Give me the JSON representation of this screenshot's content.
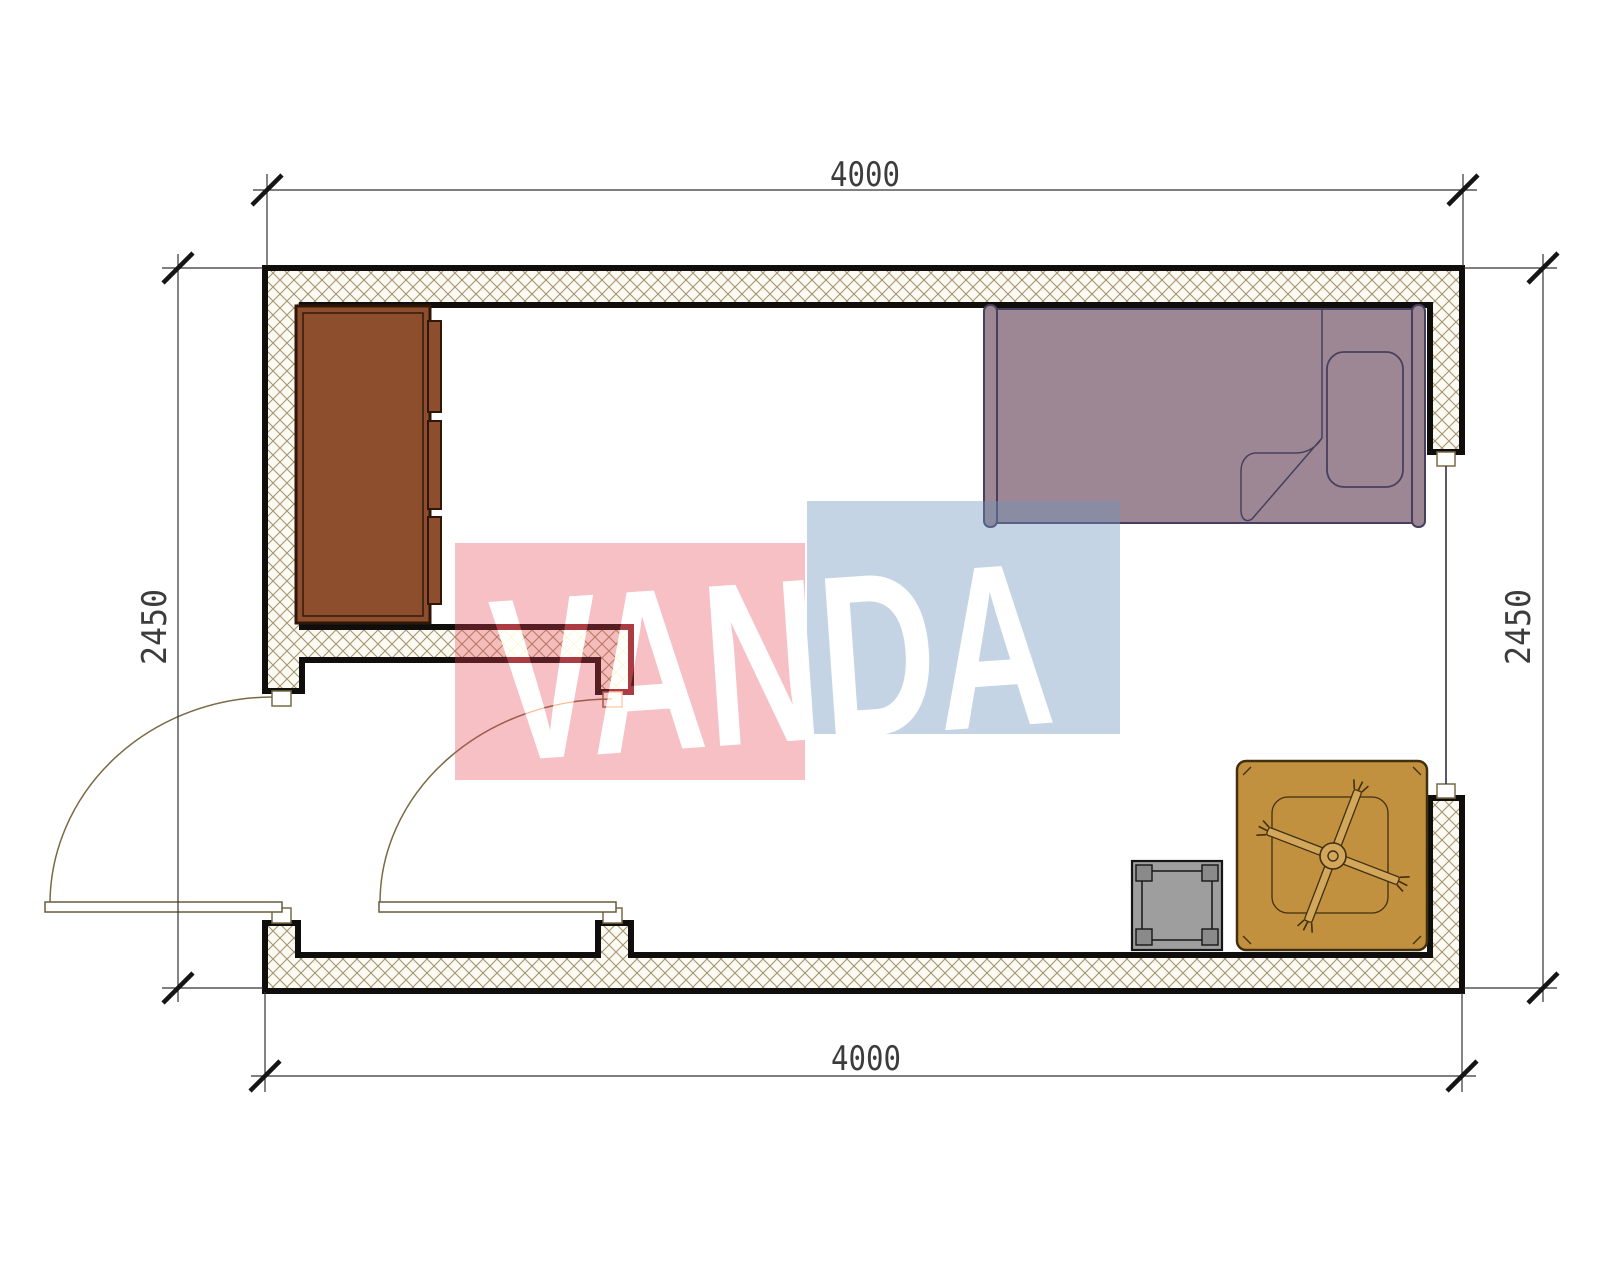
{
  "page": {
    "background": "#ffffff"
  },
  "dimensions": {
    "top": "4000",
    "bottom": "4000",
    "left": "2450",
    "right": "2450"
  },
  "watermark": {
    "text": "VANDA",
    "red": "#e8414e",
    "blue": "#6e93bb"
  },
  "colors": {
    "wall_line": "#0f0e0c",
    "hatch_line": "#a3956f",
    "hatch_bg": "#fcfaf2",
    "cabinet": "#8d4e2e",
    "cabinet_line": "#2f1608",
    "bed": "#9d8794",
    "bed_line": "#46405e",
    "table": "#c2913f",
    "table_line": "#40300e",
    "fan_blade": "#d2a75b",
    "stool": "#9e9e9e",
    "stool_leg": "#8a8a8a",
    "stool_line": "#161616",
    "door_line": "#7a6a45",
    "window_line": "#2f2f44",
    "dimension_line": "#333333",
    "dimension_text": "#3c3c3c"
  },
  "furniture": {
    "wardrobe": "wardrobe",
    "bed": "single-bed",
    "pillow": "pillow",
    "blanket": "folded-blanket-corner",
    "table": "low-table",
    "fan": "ceiling-fan",
    "stool": "stool",
    "door_left": "entry-door-swing",
    "door_inner": "inner-door-swing",
    "window": "window"
  }
}
